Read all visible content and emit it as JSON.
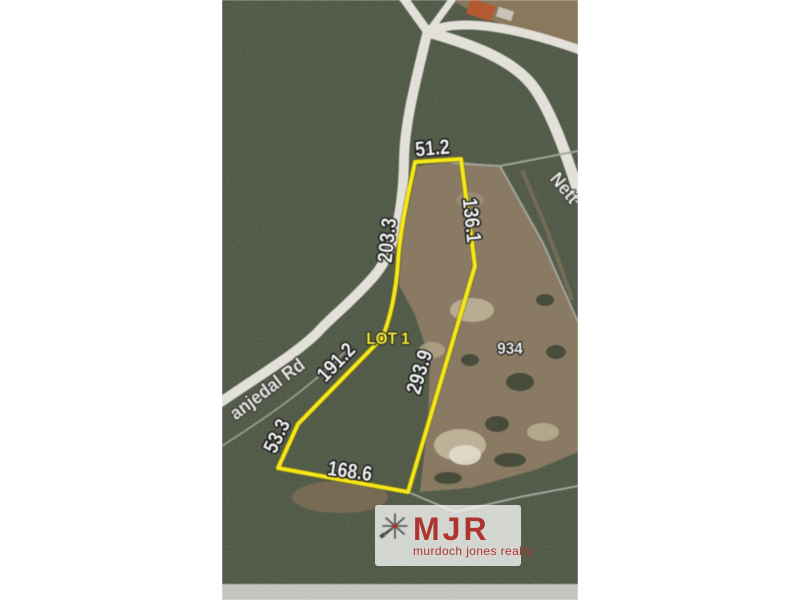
{
  "map": {
    "measurements": [
      {
        "id": "top",
        "text": "51.2"
      },
      {
        "id": "upper-right",
        "text": "136.1"
      },
      {
        "id": "upper-left",
        "text": "203.3"
      },
      {
        "id": "mid-left",
        "text": "191.2"
      },
      {
        "id": "lower-left",
        "text": "53.3"
      },
      {
        "id": "bottom",
        "text": "168.6"
      },
      {
        "id": "lower-right",
        "text": "293.9"
      }
    ],
    "lot_label": "LOT 1",
    "neighbor_lot_number": "934",
    "road_labels": [
      {
        "id": "west-road",
        "text": "anjedal Rd"
      },
      {
        "id": "north-road",
        "text": "Nett"
      }
    ],
    "watermark": {
      "initials": "MJR",
      "tagline": "murdoch jones realty"
    },
    "colors": {
      "boundary_yellow": "#ffee15",
      "lot_text_yellow": "#f0e93c",
      "watermark_red": "#ae3430",
      "road_gray": "#e9e7e0",
      "parcel_line_gray": "#a8a8a0"
    }
  }
}
